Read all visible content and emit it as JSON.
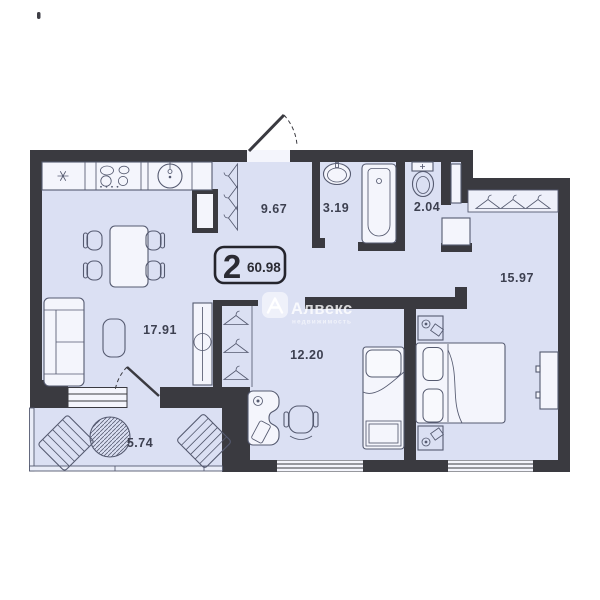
{
  "badge": {
    "rooms_count": "2",
    "total_area": "60.98"
  },
  "rooms": [
    {
      "name": "hallway",
      "area": "9.67"
    },
    {
      "name": "bathroom",
      "area": "3.19"
    },
    {
      "name": "toilet",
      "area": "2.04"
    },
    {
      "name": "bedroom",
      "area": "15.97"
    },
    {
      "name": "living-room",
      "area": "17.91"
    },
    {
      "name": "room",
      "area": "12.20"
    },
    {
      "name": "balcony",
      "area": "5.74"
    }
  ],
  "watermark": {
    "brand": "Алвекс",
    "tagline": "недвижимость"
  },
  "colors": {
    "floor": "#dbe0f3",
    "walls": "#3a3a40",
    "line": "#555a70",
    "fixture": "#f4f5fc",
    "label": "#3d4050",
    "badge-border": "#24242c"
  }
}
